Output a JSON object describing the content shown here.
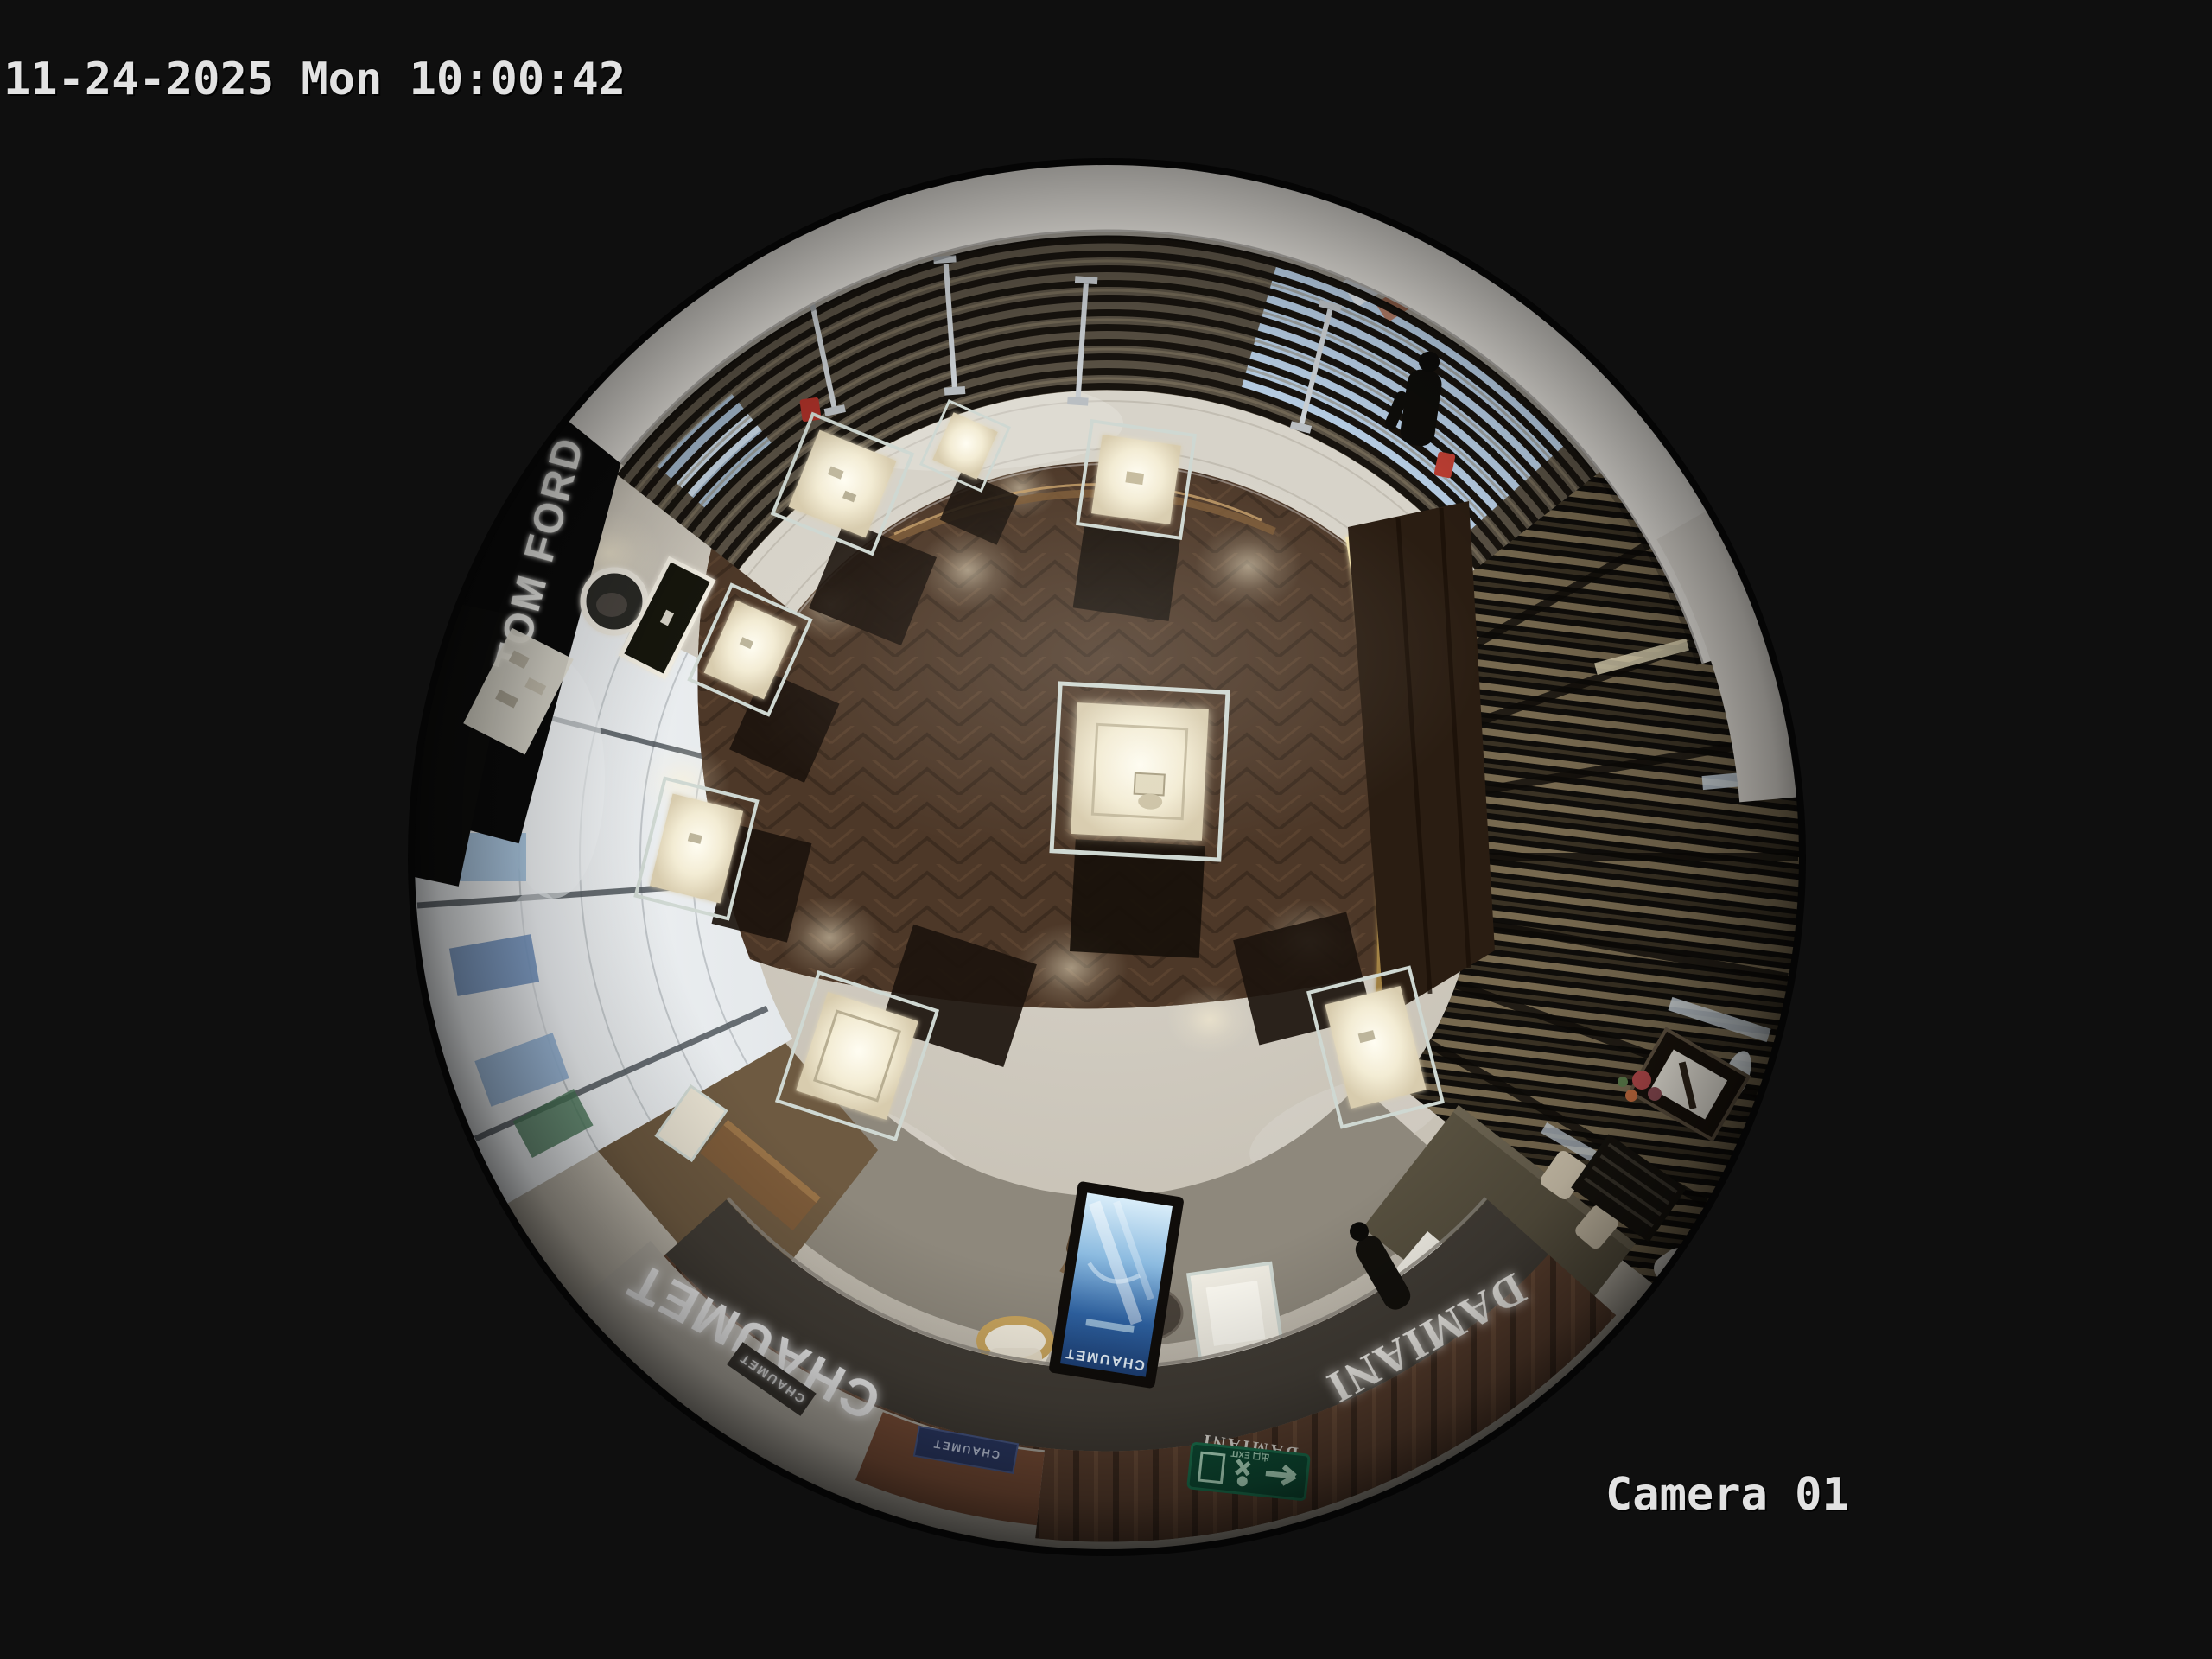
{
  "osd": {
    "timestamp": "11-24-2025 Mon 10:00:42",
    "camera_label": "Camera 01"
  },
  "scene": {
    "description": "overhead fisheye view of jewelry boutique floor",
    "brands": {
      "tom_ford": "TOM FORD",
      "chaumet_fascia": "CHAUMET",
      "chaumet_small": "CHAUMET",
      "chaumet_plaque": "CHAUMET",
      "chaumet_screen": "CHAUMET",
      "damiani_fascia": "DAMIANI",
      "damiani_door": "DAMIANI",
      "exit_sign": "出口 EXIT"
    },
    "colors": {
      "background": "#0f0f0f",
      "osd_text": "#e2e2e2",
      "wood_floor": "#4d3828",
      "stone_floor": "#c9c3b7",
      "fascia_band": "#423d36",
      "carpet": "#8e887c",
      "screen_blue": "#2e62a2",
      "exit_green": "#0f5138",
      "gold_trim": "#c9a55e",
      "white_ceiling": "#e8e5df"
    }
  }
}
